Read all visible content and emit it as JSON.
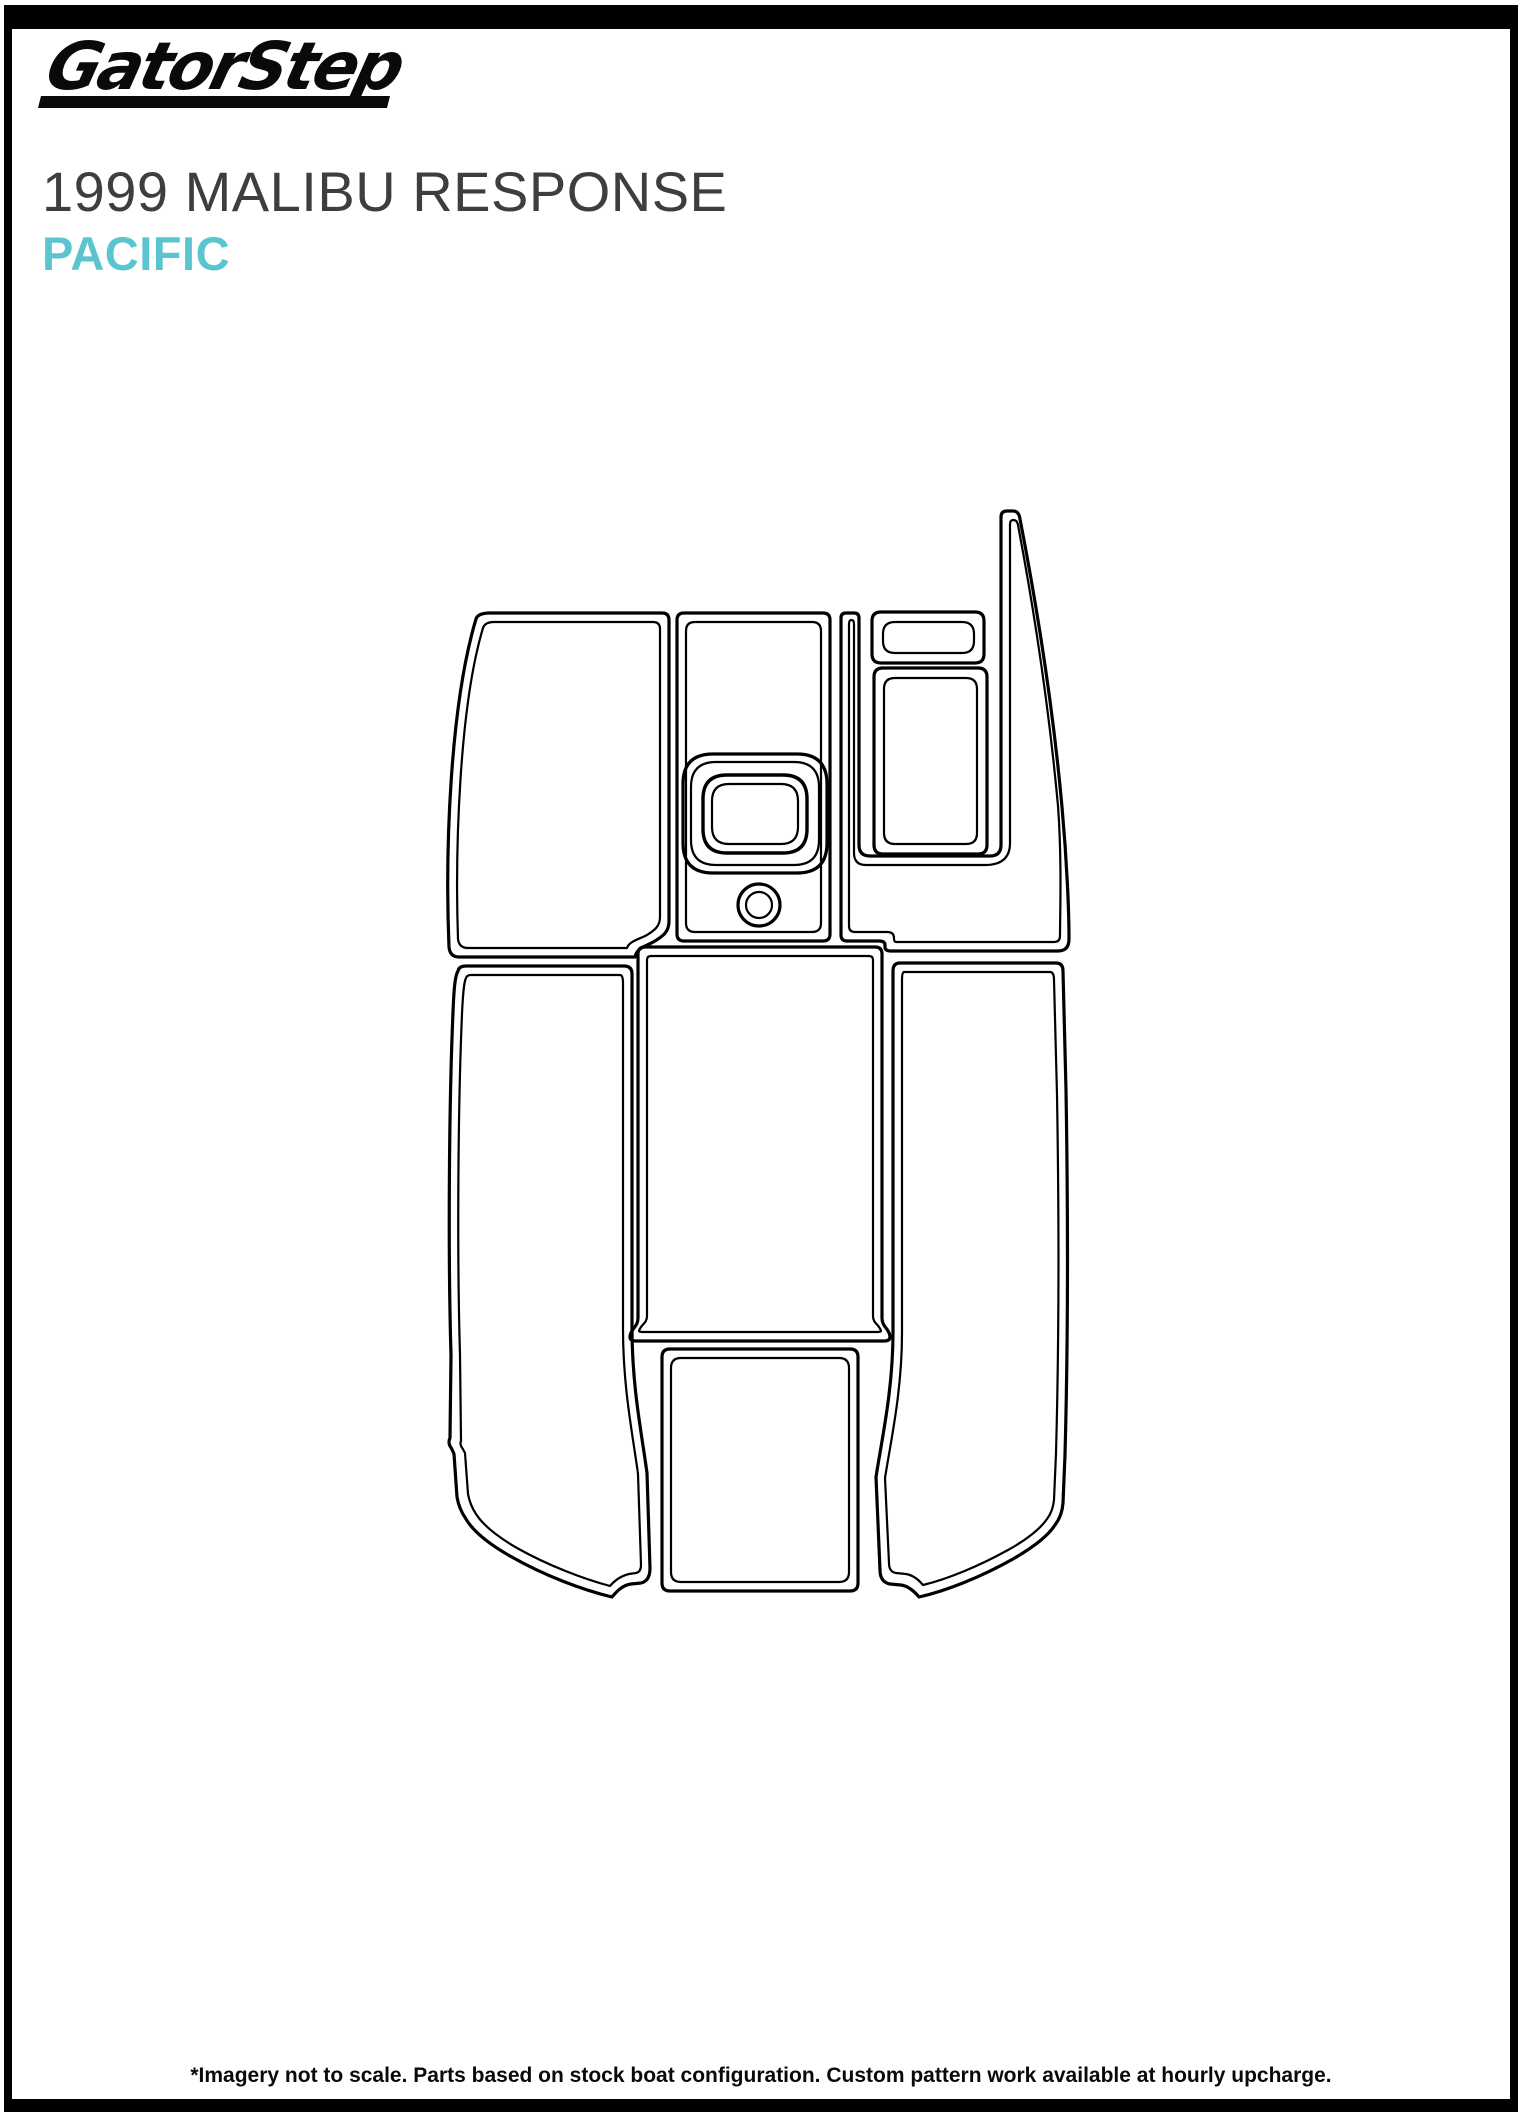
{
  "header": {
    "logo_text": "GatorStep"
  },
  "title": {
    "line1": "1999 MALIBU RESPONSE",
    "line2": "PACIFIC"
  },
  "colors": {
    "title_gray": "#3e3e40",
    "accent_teal": "#5bc5cf",
    "line_black": "#000000",
    "frame_black": "#0a0a0a"
  },
  "footer": {
    "note": "*Imagery not to scale. Parts based on stock boat configuration. Custom pattern work available at hourly upcharge."
  }
}
